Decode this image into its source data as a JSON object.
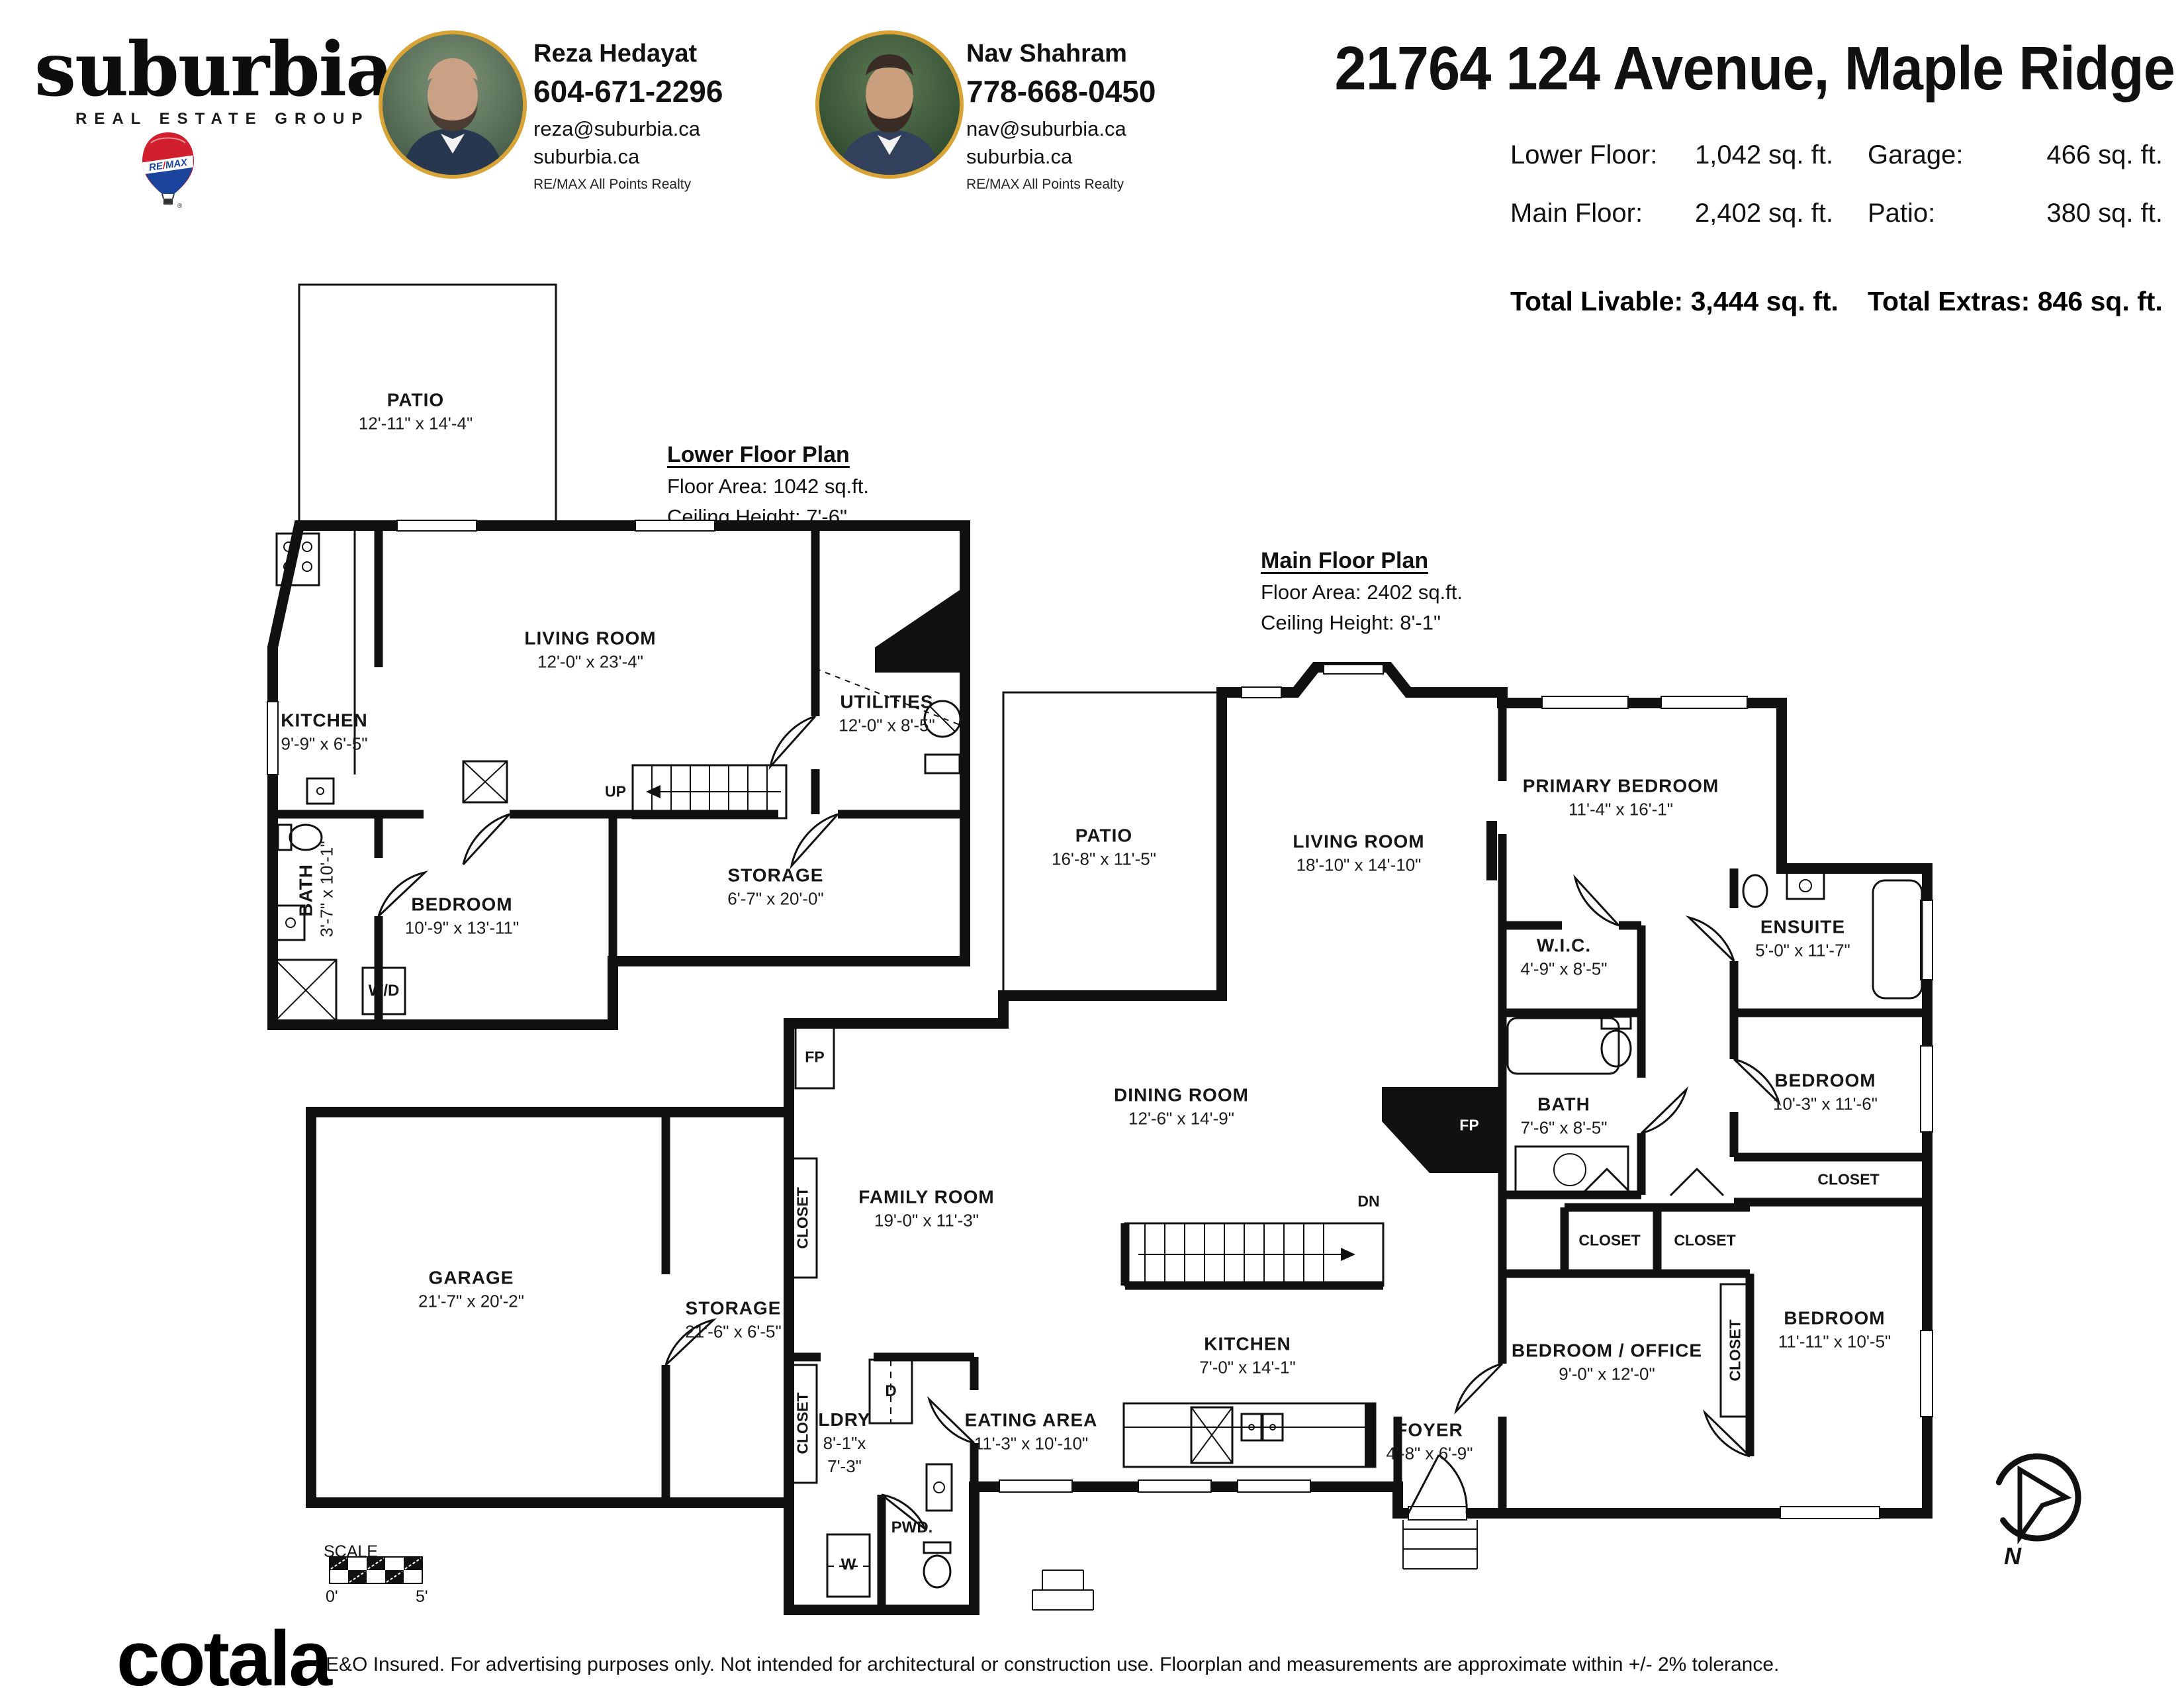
{
  "header": {
    "brand": {
      "name": "suburbia",
      "dot": ".",
      "tagline": "REAL ESTATE GROUP",
      "balloon": "RE/MAX",
      "accent_gold": "#eeb033",
      "remax_red": "#e11b22",
      "remax_blue": "#1b449c"
    },
    "agents": [
      {
        "name": "Reza Hedayat",
        "phone": "604-671-2296",
        "email": "reza@suburbia.ca",
        "website": "suburbia.ca",
        "brokerage": "RE/MAX All Points Realty"
      },
      {
        "name": "Nav Shahram",
        "phone": "778-668-0450",
        "email": "nav@suburbia.ca",
        "website": "suburbia.ca",
        "brokerage": "RE/MAX All Points Realty"
      }
    ],
    "title": "21764 124 Avenue, Maple Ridge",
    "stats": {
      "lower_floor_label": "Lower Floor:",
      "lower_floor_value": "1,042 sq. ft.",
      "main_floor_label": "Main Floor:",
      "main_floor_value": "2,402 sq. ft.",
      "garage_label": "Garage:",
      "garage_value": "466 sq. ft.",
      "patio_label": "Patio:",
      "patio_value": "380 sq. ft.",
      "total_livable": "Total Livable: 3,444 sq. ft.",
      "total_extras": "Total Extras: 846 sq. ft."
    }
  },
  "lower_plan": {
    "heading": "Lower Floor Plan",
    "floor_area": "Floor Area: 1042 sq.ft.",
    "ceiling": "Ceiling Height: 7'-6\""
  },
  "main_plan": {
    "heading": "Main Floor Plan",
    "floor_area": "Floor Area: 2402 sq.ft.",
    "ceiling": "Ceiling Height: 8'-1\""
  },
  "rooms": {
    "lower_patio": {
      "name": "PATIO",
      "dims": "12'-11\" x 14'-4\""
    },
    "lower_living": {
      "name": "LIVING ROOM",
      "dims": "12'-0\" x 23'-4\""
    },
    "lower_utilities": {
      "name": "UTILITIES",
      "dims": "12'-0\" x 8'-5\""
    },
    "lower_kitchen": {
      "name": "KITCHEN",
      "dims": "9'-9\" x 6'-5\""
    },
    "lower_bath": {
      "name": "BATH",
      "dims": "3'-7\" x 10'-1\""
    },
    "lower_bedroom": {
      "name": "BEDROOM",
      "dims": "10'-9\" x 13'-11\""
    },
    "lower_storage": {
      "name": "STORAGE",
      "dims": "6'-7\" x 20'-0\""
    },
    "main_patio": {
      "name": "PATIO",
      "dims": "16'-8\" x 11'-5\""
    },
    "main_living": {
      "name": "LIVING ROOM",
      "dims": "18'-10\" x 14'-10\""
    },
    "primary_bedroom": {
      "name": "PRIMARY BEDROOM",
      "dims": "11'-4\" x 16'-1\""
    },
    "wic": {
      "name": "W.I.C.",
      "dims": "4'-9\" x 8'-5\""
    },
    "ensuite": {
      "name": "ENSUITE",
      "dims": "5'-0\" x 11'-7\""
    },
    "main_bath": {
      "name": "BATH",
      "dims": "7'-6\" x 8'-5\""
    },
    "bedroom_ur": {
      "name": "BEDROOM",
      "dims": "10'-3\" x 11'-6\""
    },
    "dining": {
      "name": "DINING ROOM",
      "dims": "12'-6\" x 14'-9\""
    },
    "family": {
      "name": "FAMILY ROOM",
      "dims": "19'-0\" x 11'-3\""
    },
    "garage": {
      "name": "GARAGE",
      "dims": "21'-7\" x 20'-2\""
    },
    "main_storage": {
      "name": "STORAGE",
      "dims": "21'-6\" x 6'-5\""
    },
    "ldry": {
      "name": "LDRY",
      "dims": "8'-1\"x",
      "dims2": "7'-3\""
    },
    "eating": {
      "name": "EATING AREA",
      "dims": "11'-3\" x 10'-10\""
    },
    "main_kitchen": {
      "name": "KITCHEN",
      "dims": "7'-0\" x 14'-1\""
    },
    "foyer": {
      "name": "FOYER",
      "dims": "4'-8\" x 6'-9\""
    },
    "bedroom_office": {
      "name": "BEDROOM / OFFICE",
      "dims": "9'-0\" x 12'-0\""
    },
    "bedroom_lr": {
      "name": "BEDROOM",
      "dims": "11'-11\" x 10'-5\""
    }
  },
  "small_labels": {
    "up": "UP",
    "dn": "DN",
    "fp": "FP",
    "wd": "W/D",
    "washer": "W",
    "dryer": "D",
    "pwd": "PWD.",
    "closet": "CLOSET",
    "north": "N"
  },
  "scale_bar": {
    "label": "SCALE",
    "start": "0'",
    "end": "5'"
  },
  "footer": {
    "logo": "cotala",
    "tm": "TM",
    "disclaimer": "E&O Insured. For advertising purposes only. Not intended for architectural or construction use. Floorplan and measurements are approximate within +/- 2% tolerance."
  }
}
